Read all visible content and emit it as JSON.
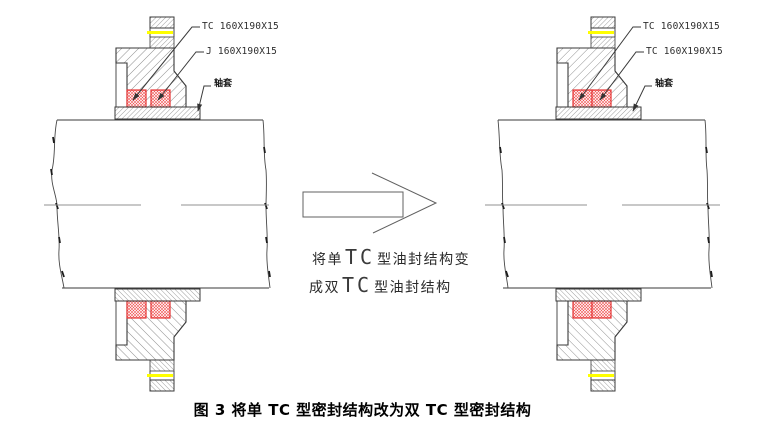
{
  "caption": {
    "text": "图 3 将单 TC 型密封结构改为双 TC 型密封结构"
  },
  "left_diagram": {
    "labels": {
      "seal1": "TC 160X190X15",
      "seal2": "J 160X190X15",
      "sleeve": "轴套"
    }
  },
  "right_diagram": {
    "labels": {
      "seal1": "TC 160X190X15",
      "seal2": "TC 160X190X15",
      "sleeve": "轴套"
    }
  },
  "annotation": {
    "line1": {
      "prefix": "将单",
      "tc": "TC",
      "suffix": "型油封结构变"
    },
    "line2": {
      "prefix": "成双",
      "tc": "TC",
      "suffix": "型油封结构"
    }
  },
  "colors": {
    "outline": "#3a3a3a",
    "hatch": "#6a6a6a",
    "seal_red": "#e63333",
    "highlight_yellow": "#ffff00",
    "centerline_gray": "#909090"
  }
}
